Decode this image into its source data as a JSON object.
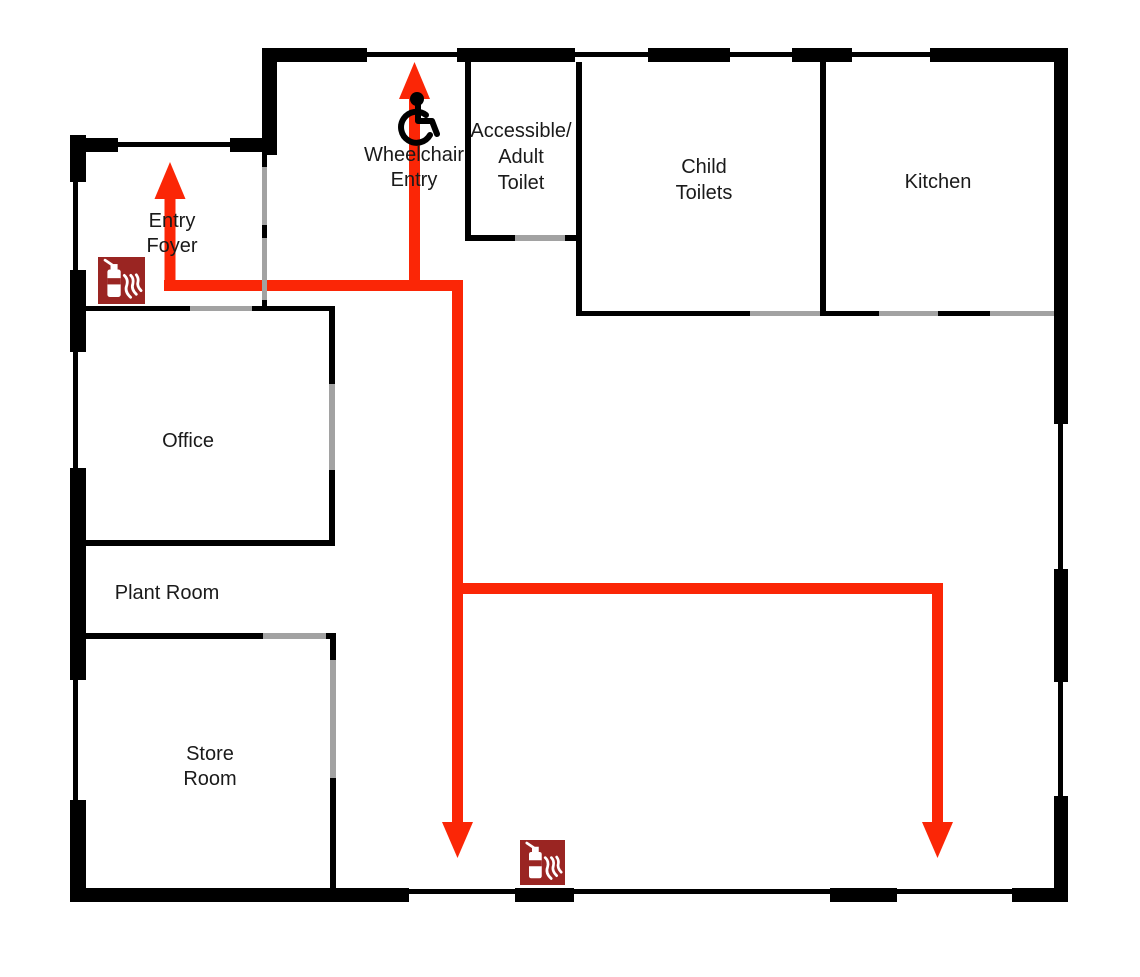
{
  "diagram": {
    "kind": "evacuation-floor-plan",
    "background": "#ffffff"
  },
  "colors": {
    "background": "#ffffff",
    "wall": "#000000",
    "door": "#a2a2a2",
    "route": "#fb2606",
    "fire_icon_bg": "#9a2522",
    "fire_icon_fg": "#ffffff",
    "wheelchair_icon": "#000000",
    "label_text": "#1a1a1a"
  },
  "rooms": [
    {
      "id": "entry-foyer",
      "lines": [
        "Entry",
        "Foyer"
      ]
    },
    {
      "id": "wheelchair-entry",
      "lines": [
        "Wheelchair",
        "Entry"
      ]
    },
    {
      "id": "accessible-adult-toilet",
      "lines": [
        "Accessible/",
        "Adult",
        "Toilet"
      ]
    },
    {
      "id": "child-toilets",
      "lines": [
        "Child",
        "Toilets"
      ]
    },
    {
      "id": "kitchen",
      "lines": [
        "Kitchen"
      ]
    },
    {
      "id": "office",
      "lines": [
        "Office"
      ]
    },
    {
      "id": "plant-room",
      "lines": [
        "Plant Room"
      ]
    },
    {
      "id": "store-room",
      "lines": [
        "Store",
        "Room"
      ]
    }
  ],
  "icons": {
    "fire_extinguisher": {
      "name": "fire-extinguisher-icon",
      "count": 2
    },
    "wheelchair": {
      "name": "wheelchair-icon",
      "count": 1
    }
  },
  "routes": [
    {
      "id": "entry-foyer-exit",
      "arrow_direction": "up"
    },
    {
      "id": "wheelchair-entry-exit",
      "arrow_direction": "up"
    },
    {
      "id": "hall-south-exit",
      "arrow_direction": "down"
    },
    {
      "id": "hall-east-south-exit",
      "arrow_direction": "down"
    }
  ]
}
